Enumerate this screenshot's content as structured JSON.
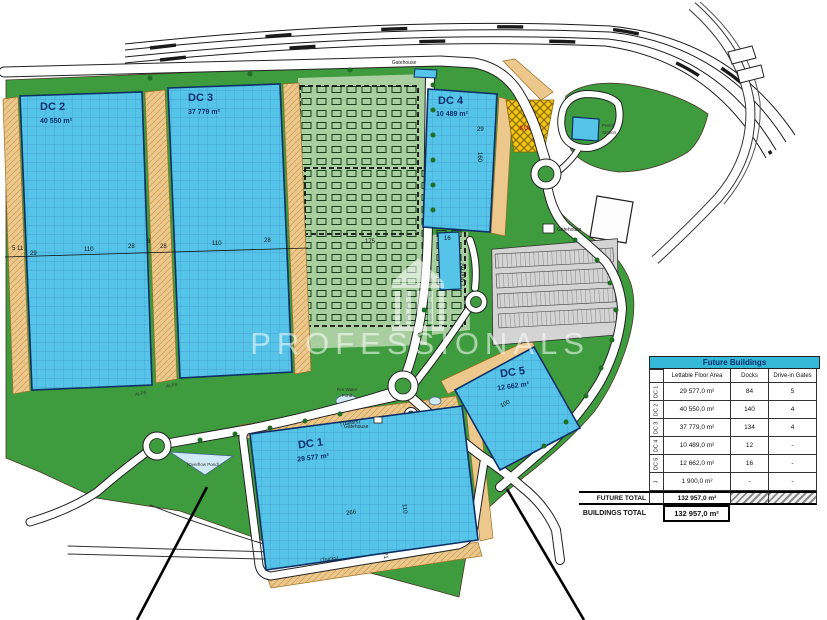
{
  "colors": {
    "grass": "#3e9b3e",
    "future_area": "#a9cfa0",
    "building": "#56c4e9",
    "building_outline": "#0d2f66",
    "apron": "#edc88c",
    "parking": "#d4d4d4",
    "pond": "#cfe9f5",
    "kulak_yellow": "#f2c618",
    "road": "#ffffff",
    "table_header": "#35b9d9",
    "label_navy": "#0a2f6e"
  },
  "watermark": {
    "text": "PROFESSIONALS"
  },
  "buildings": {
    "dc1": {
      "name": "DC 1",
      "area": "29 577 m²"
    },
    "dc2": {
      "name": "DC 2",
      "area": "40 550 m²"
    },
    "dc3": {
      "name": "DC 3",
      "area": "37 779 m²"
    },
    "dc4": {
      "name": "DC 4",
      "area": "10 489 m²"
    },
    "dc5": {
      "name": "DC 5",
      "area": "12 662 m²"
    },
    "j": {
      "area": "1 900 m²"
    }
  },
  "labels": {
    "gatehouse": "Gatehouse",
    "petrol1": "Petrol",
    "petrol2": "Station",
    "kulak": "KULAK",
    "overflow_pond": "(Overflow Pond)",
    "fire_water1": "Fire Water",
    "fire_water2": "Pond",
    "trailers": "(Trailers)",
    "trucks": "(Trucks)",
    "alps": "ALPS"
  },
  "dims": {
    "row": [
      "5 11",
      "29",
      "110",
      "28",
      "8",
      "28",
      "110",
      "28"
    ],
    "c175": "175",
    "dc1_266": "266",
    "dc1_110": "110",
    "dc1_21": "21",
    "dc4_29": "29",
    "dc4_160": "160",
    "j_16": "16",
    "dc5_100": "100"
  },
  "table": {
    "title": "Future Buildings",
    "columns": [
      "Lettable Floor Area",
      "Docks",
      "Drive-in Gates"
    ],
    "rows": [
      {
        "label": "DC 1",
        "area": "29 577,0 m²",
        "docks": "84",
        "gates": "5"
      },
      {
        "label": "DC 2",
        "area": "40 550,0 m²",
        "docks": "140",
        "gates": "4"
      },
      {
        "label": "DC 3",
        "area": "37 779,0 m²",
        "docks": "134",
        "gates": "4"
      },
      {
        "label": "DC 4",
        "area": "10 489,0 m²",
        "docks": "12",
        "gates": "-"
      },
      {
        "label": "DC 5",
        "area": "12 662,0 m²",
        "docks": "16",
        "gates": "-"
      },
      {
        "label": "J",
        "area": "1 900,0 m²",
        "docks": "-",
        "gates": "-"
      }
    ],
    "future_total_label": "FUTURE TOTAL",
    "future_total": "132 957,0 m²",
    "buildings_total_label": "BUILDINGS TOTAL",
    "buildings_total": "132 957,0 m²"
  }
}
